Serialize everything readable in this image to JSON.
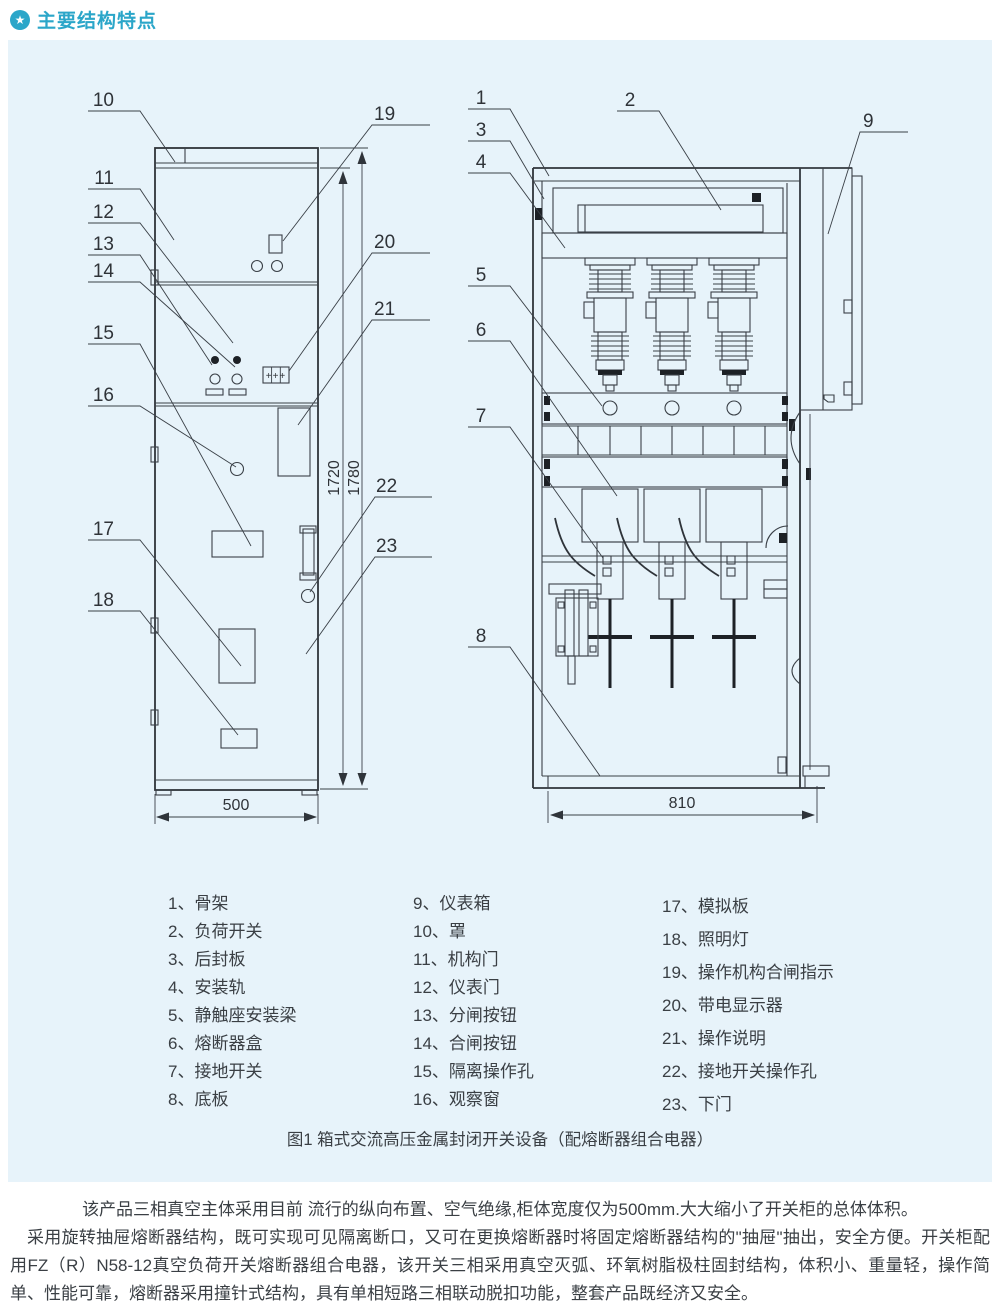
{
  "header": {
    "title": "主要结构特点",
    "accent_color": "#2ba6c9",
    "icon_glyph": "★"
  },
  "figure": {
    "panel_bg": "#e7f3fa",
    "caption": "图1 箱式交流高压金属封闭开关设备（配熔断器组合电器）",
    "display_glyph": "+++",
    "callout_numbers": [
      "1",
      "2",
      "3",
      "4",
      "5",
      "6",
      "7",
      "8",
      "9",
      "10",
      "11",
      "12",
      "13",
      "14",
      "15",
      "16",
      "17",
      "18",
      "19",
      "20",
      "21",
      "22",
      "23"
    ],
    "dimensions": {
      "left_width": "500",
      "right_width": "810",
      "inner_height": "1720",
      "outer_height": "1780"
    }
  },
  "parts_list": {
    "columns": [
      {
        "items": [
          "1、骨架",
          "2、负荷开关",
          "3、后封板",
          "4、安装轨",
          "5、静触座安装梁",
          "6、熔断器盒",
          "7、接地开关",
          "8、底板"
        ]
      },
      {
        "items": [
          "9、仪表箱",
          "10、罩",
          "11、机构门",
          "12、仪表门",
          "13、分闸按钮",
          "14、合闸按钮",
          "15、隔离操作孔",
          "16、观察窗"
        ]
      },
      {
        "items": [
          "17、模拟板",
          "18、照明灯",
          "19、操作机构合闸指示",
          "20、带电显示器",
          "21、操作说明",
          "22、接地开关操作孔",
          "23、下门"
        ]
      }
    ]
  },
  "description": {
    "p1": "该产品三相真空主体采用目前 流行的纵向布置、空气绝缘,柜体宽度仅为500mm.大大缩小了开关柜的总体体积。",
    "p2": "采用旋转抽屉熔断器结构，既可实现可见隔离断口，又可在更换熔断器时将固定熔断器结构的\"抽屉\"抽出，安全方便。开关柜配用FZ（R）N58-12真空负荷开关熔断器组合电器，该开关三相采用真空灭弧、环氧树脂极柱固封结构，体积小、重量轻，操作简单、性能可靠，熔断器采用撞针式结构，具有单相短路三相联动脱扣功能，整套产品既经济又安全。"
  }
}
